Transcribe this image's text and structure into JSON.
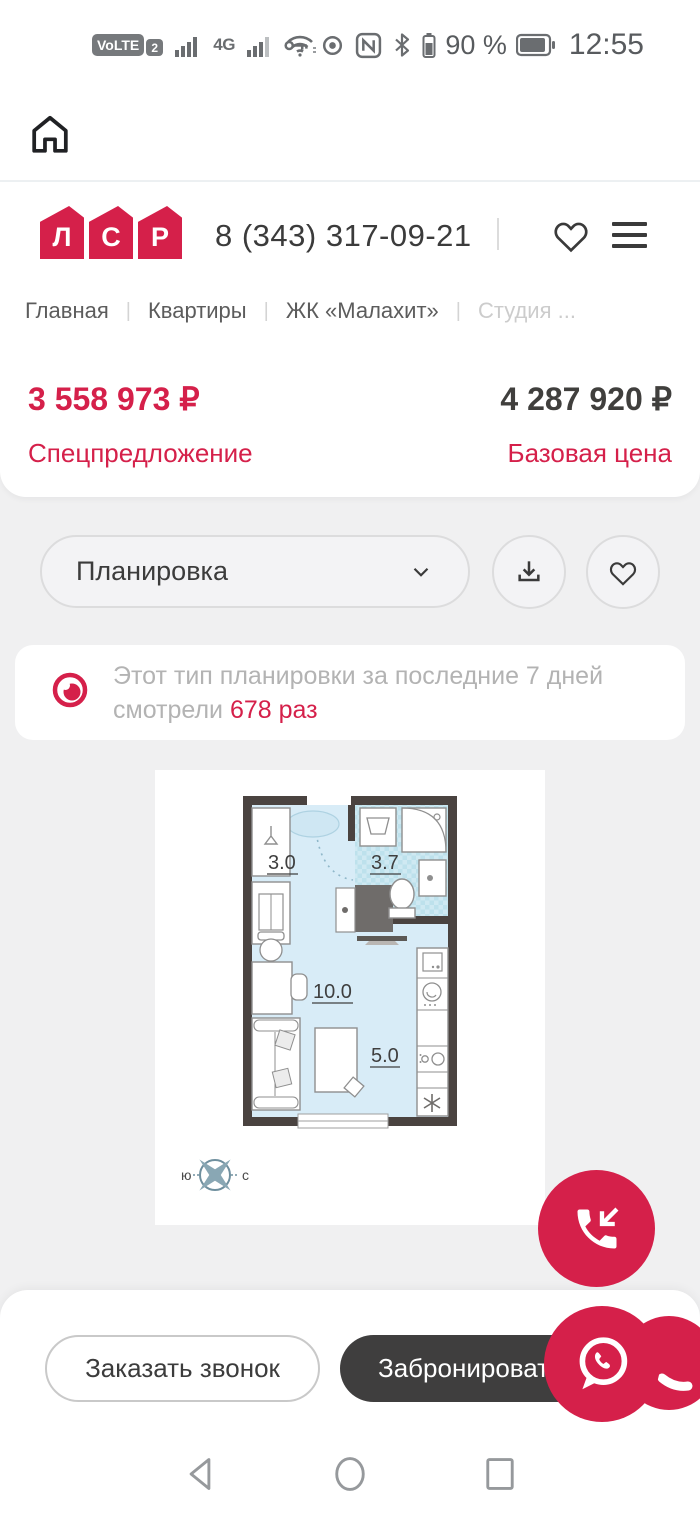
{
  "status_bar": {
    "volte_label": "VoLTE",
    "sim_badge": "2",
    "network_label": "4G",
    "battery_percent": "90 %",
    "time": "12:55"
  },
  "browser_bar": {
    "url": "lsr.ru/ekb/kvartiry-v",
    "tab_count": "47",
    "adblock_label": "ABP"
  },
  "site_header": {
    "logo_letters": [
      "Л",
      "С",
      "Р"
    ],
    "phone": "8 (343) 317-09-21"
  },
  "breadcrumb": {
    "divider": "|",
    "items": [
      "Главная",
      "Квартиры",
      "ЖК «Малахит»",
      "Студия ..."
    ]
  },
  "pricing": {
    "special_price": "3 558 973 ₽",
    "special_label": "Спецпредложение",
    "base_price": "4 287 920 ₽",
    "base_label": "Базовая цена"
  },
  "controls": {
    "dropdown_label": "Планировка"
  },
  "views_info": {
    "prefix": "Этот тип планировки за последние 7 дней смотрели",
    "highlight": "678 раз"
  },
  "floor_plan": {
    "areas": {
      "hall": "3.0",
      "bathroom": "3.7",
      "living": "10.0",
      "kitchen": "5.0"
    },
    "compass": {
      "south": "ю",
      "north": "с"
    }
  },
  "footer_actions": {
    "order_call": "Заказать звонок",
    "book": "Забронировать"
  },
  "colors": {
    "accent": "#d5204a",
    "dark_button": "#3f3e3e",
    "page_gray": "#f0f0f1"
  }
}
